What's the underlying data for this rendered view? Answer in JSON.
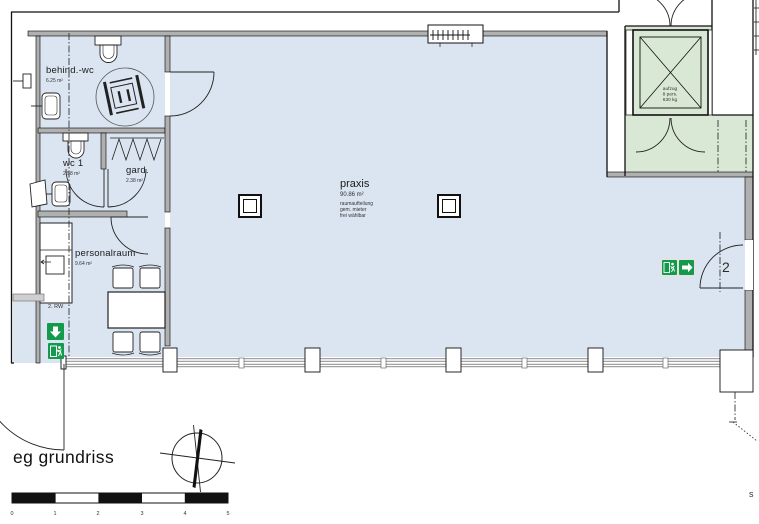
{
  "title": "eg grundriss",
  "plan": {
    "rooms": [
      {
        "name": "behind.-wc",
        "area": "6.25 m²"
      },
      {
        "name": "wc 1",
        "area": "2.58 m²"
      },
      {
        "name": "gard.",
        "area": "2.38 m²"
      },
      {
        "name": "personalraum",
        "area": "9.64 m²"
      },
      {
        "name": "praxis",
        "area": "90.86 m²",
        "note_line1": "raumaufteilung",
        "note_line2": "gem. mieter",
        "note_line3": "frei wählbar"
      }
    ],
    "elevator": {
      "line1": "aufzug",
      "line2": "8 pers.",
      "line3": "630 kg"
    },
    "escape_route_label": "2. RW",
    "door_number": "2",
    "edge_label": "s"
  },
  "scale_bar": {
    "ticks": [
      "0",
      "1",
      "2",
      "3",
      "4",
      "5"
    ]
  },
  "icons": {
    "wheelchair": "wheelchair-icon",
    "exit_running_man": "running-man-icon",
    "exit_arrow_right": "arrow-right-icon",
    "exit_arrow_down": "arrow-down-icon",
    "north_compass": "north-arrow-icon",
    "elevator_cross": "elevator-x-icon"
  },
  "colors": {
    "floor": "#dbe5f1",
    "circulation_green": "#d9e8d5",
    "exit_sign_green": "#149a4d",
    "wall_gray": "#b0b0b0"
  }
}
